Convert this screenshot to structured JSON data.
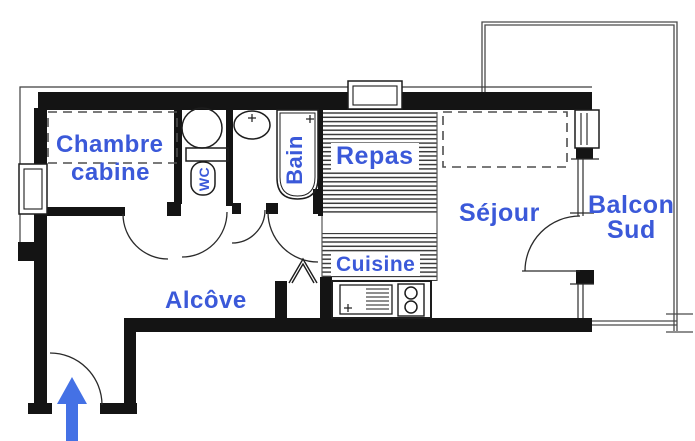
{
  "plan": {
    "type": "apartment-floor-plan",
    "label_color": "#3b59d9",
    "arrow_color": "#4471e5",
    "rooms": {
      "chambre_line1": "Chambre",
      "chambre_line2": "cabine",
      "wc": "WC",
      "bain": "Bain",
      "repas": "Repas",
      "cuisine": "Cuisine",
      "sejour": "Séjour",
      "balcon_line1": "Balcon",
      "balcon_line2": "Sud",
      "alcove": "Alcôve"
    },
    "icons": {
      "entrance": "entrance-arrow",
      "wc_room_top": "water-heater-circle",
      "wc_room": "toilet",
      "bain_top": "washbasin-oval",
      "bain_right": "bathtub",
      "kitchen_left": "kitchen-sink",
      "kitchen_right": "stove-2-burners",
      "closet": "folding-door"
    }
  }
}
